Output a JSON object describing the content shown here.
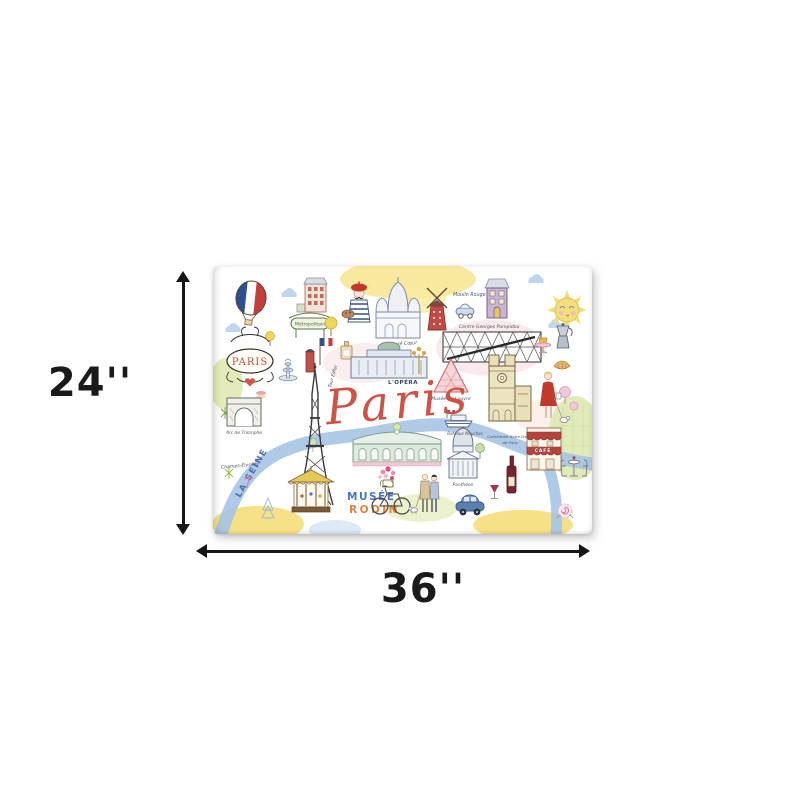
{
  "dimensions": {
    "height_label": "24''",
    "width_label": "36''"
  },
  "artwork": {
    "script_title": "Paris",
    "labels": {
      "paris_sign": "PARIS",
      "metropolitain": "Métropolitain",
      "sacre_coeur": "Sacré Cœur",
      "moulin_rouge": "Moulin Rouge",
      "centre_pompidou": "Centre Georges Pompidou",
      "opera": "L'OPÉRA",
      "louvre": "Musée du Louvre",
      "notre_dame_line1": "Cathédrale Notre Dame",
      "notre_dame_line2": "de Paris",
      "arc_de_triomphe": "Arc de Triomphe",
      "champs_elysees": "Champs-Élysées",
      "la_seine": "LA SEINE",
      "tour_eiffel": "Tour Eiffel",
      "bateaux_mouches": "Bateaux Mouches",
      "pantheon": "Panthéon",
      "cafe": "CAFÉ",
      "musee_rodin_line1": "MUSÉE",
      "musee_rodin_line2": "RODIN"
    },
    "palette": {
      "arrow_black": "#161616",
      "script_red": "#cd5347",
      "seine_blue": "#a6c4e4",
      "wash_yellow": "#f6de7a",
      "wash_pink": "#f6d9da",
      "wash_green": "#dce8ae",
      "flag_blue": "#2d4f8f",
      "flag_red": "#c23f3d",
      "moulin_red": "#c14a44",
      "rodin_blue": "#4a76c4",
      "rodin_orange": "#e0823c"
    }
  }
}
